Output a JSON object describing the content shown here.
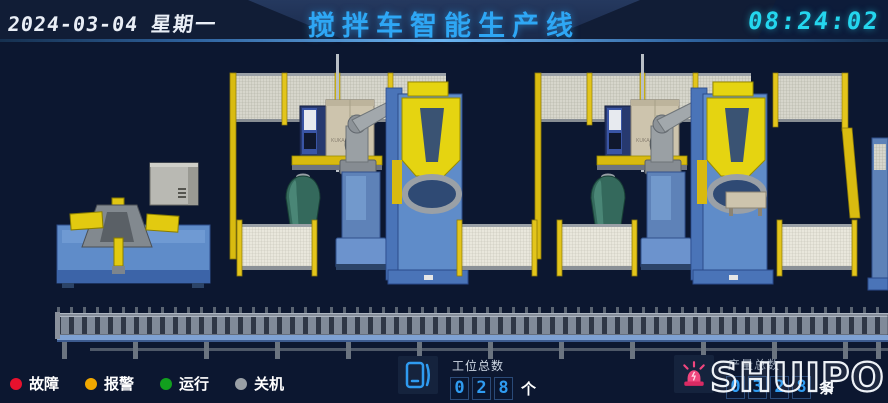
{
  "header": {
    "date": "2024-03-04",
    "weekday": "星期一",
    "title": "搅拌车智能生产线",
    "time": "08:24:02"
  },
  "scene": {
    "robot_brand": "KUKA"
  },
  "footer": {
    "legend": [
      {
        "label": "故障",
        "color": "#e8112d",
        "icon": "fault-status-dot"
      },
      {
        "label": "报警",
        "color": "#f0a800",
        "icon": "alarm-status-dot"
      },
      {
        "label": "运行",
        "color": "#12a01e",
        "icon": "running-status-dot"
      },
      {
        "label": "关机",
        "color": "#9aa0a6",
        "icon": "off-status-dot"
      }
    ],
    "station_counter": {
      "icon": "tablet-device-icon",
      "label": "工位总数",
      "digits": [
        "0",
        "2",
        "8"
      ],
      "unit": "个"
    },
    "production_counter": {
      "icon": "alarm-siren-icon",
      "label": "产量总数",
      "digits": [
        "0",
        "3",
        "2",
        "8"
      ],
      "unit": "条"
    },
    "logo": "SHUIPO"
  },
  "colors": {
    "background": "#0c1730",
    "title_blue": "#2ea7f5",
    "time_cyan": "#24d6ee",
    "digit_blue": "#2f9bf0",
    "fence_yellow": "#e3c51b",
    "machine_blue": "#5f8cc9",
    "robot_yellow": "#e5d411",
    "drum_green": "#34695c",
    "siren_pink": "#f0467e"
  }
}
